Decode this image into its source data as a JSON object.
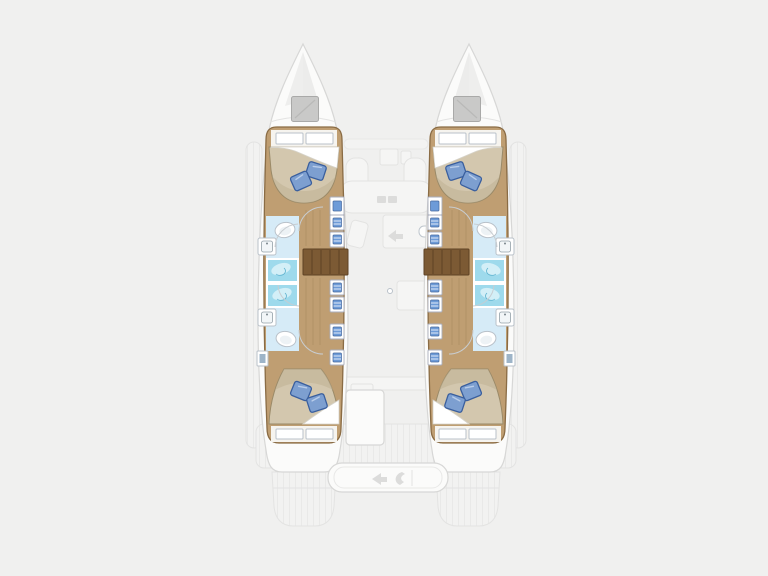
{
  "diagram": {
    "type": "boat-floorplan",
    "subject": "catamaran deck plan, top view, bow up",
    "orientation": "bow-up",
    "hulls": [
      {
        "side": "port",
        "rooms": [
          "forward-double-cabin",
          "forward-bathroom-toilet-sink",
          "two-shower-stalls",
          "aft-bathroom-toilet-sink",
          "aft-double-cabin"
        ],
        "features": [
          "bow-hatch",
          "companionway-steps",
          "storage-cabinets",
          "corridor"
        ]
      },
      {
        "side": "starboard",
        "rooms": [
          "forward-double-cabin",
          "forward-bathroom-toilet-sink",
          "two-shower-stalls",
          "aft-bathroom-toilet-sink",
          "aft-double-cabin"
        ],
        "features": [
          "bow-hatch",
          "companionway-steps",
          "storage-cabinets",
          "corridor"
        ]
      }
    ],
    "center": {
      "areas": [
        "foredeck",
        "salon-galley-ghosted",
        "nav-seat-ghosted",
        "cockpit-table",
        "cockpit-bench",
        "aft-deck",
        "swim-platforms",
        "side-decks"
      ]
    },
    "totals": {
      "double_cabins": 4,
      "toilets": 4,
      "showers": 4,
      "bow_hatches": 2,
      "pillows": 8
    }
  },
  "colors": {
    "bg": "#f0f0ef",
    "hull-white": "#fbfbfa",
    "hull-line": "#d7d7d6",
    "ghost-fill": "#f5f5f4",
    "ghost-line": "#e3e3e2",
    "ghost-detail": "#dcdcdb",
    "wood": "#bf9e72",
    "wood-edge": "#8a6c45",
    "wood-line": "#a3845a",
    "steps": "#7c5a34",
    "steps-line": "#5e4224",
    "mattress": "#d3c7ae",
    "mattress-shade": "#bfb094",
    "mattress-line": "#9a8a68",
    "sheet": "#ffffff",
    "sheet-line": "#d6d3ca",
    "pillow": "#7d9fd0",
    "pillow-dark": "#3a5f9e",
    "pillow-light": "#b9cdea",
    "bath-floor": "#d6ebf7",
    "shower": "#9edaec",
    "shower-light": "#d8f1f8",
    "shower-drain": "#5fb3cf",
    "fixture": "#ffffff",
    "fixture-line": "#b9c1c9",
    "cabinet-line": "#a9aebc",
    "cabinet-blue": "#6d9bd8",
    "cabinet-blue-dark": "#46699f",
    "hatch": "#c9c9c8",
    "hatch-line": "#a9a9a8",
    "door-arc": "#c8cdd1"
  }
}
